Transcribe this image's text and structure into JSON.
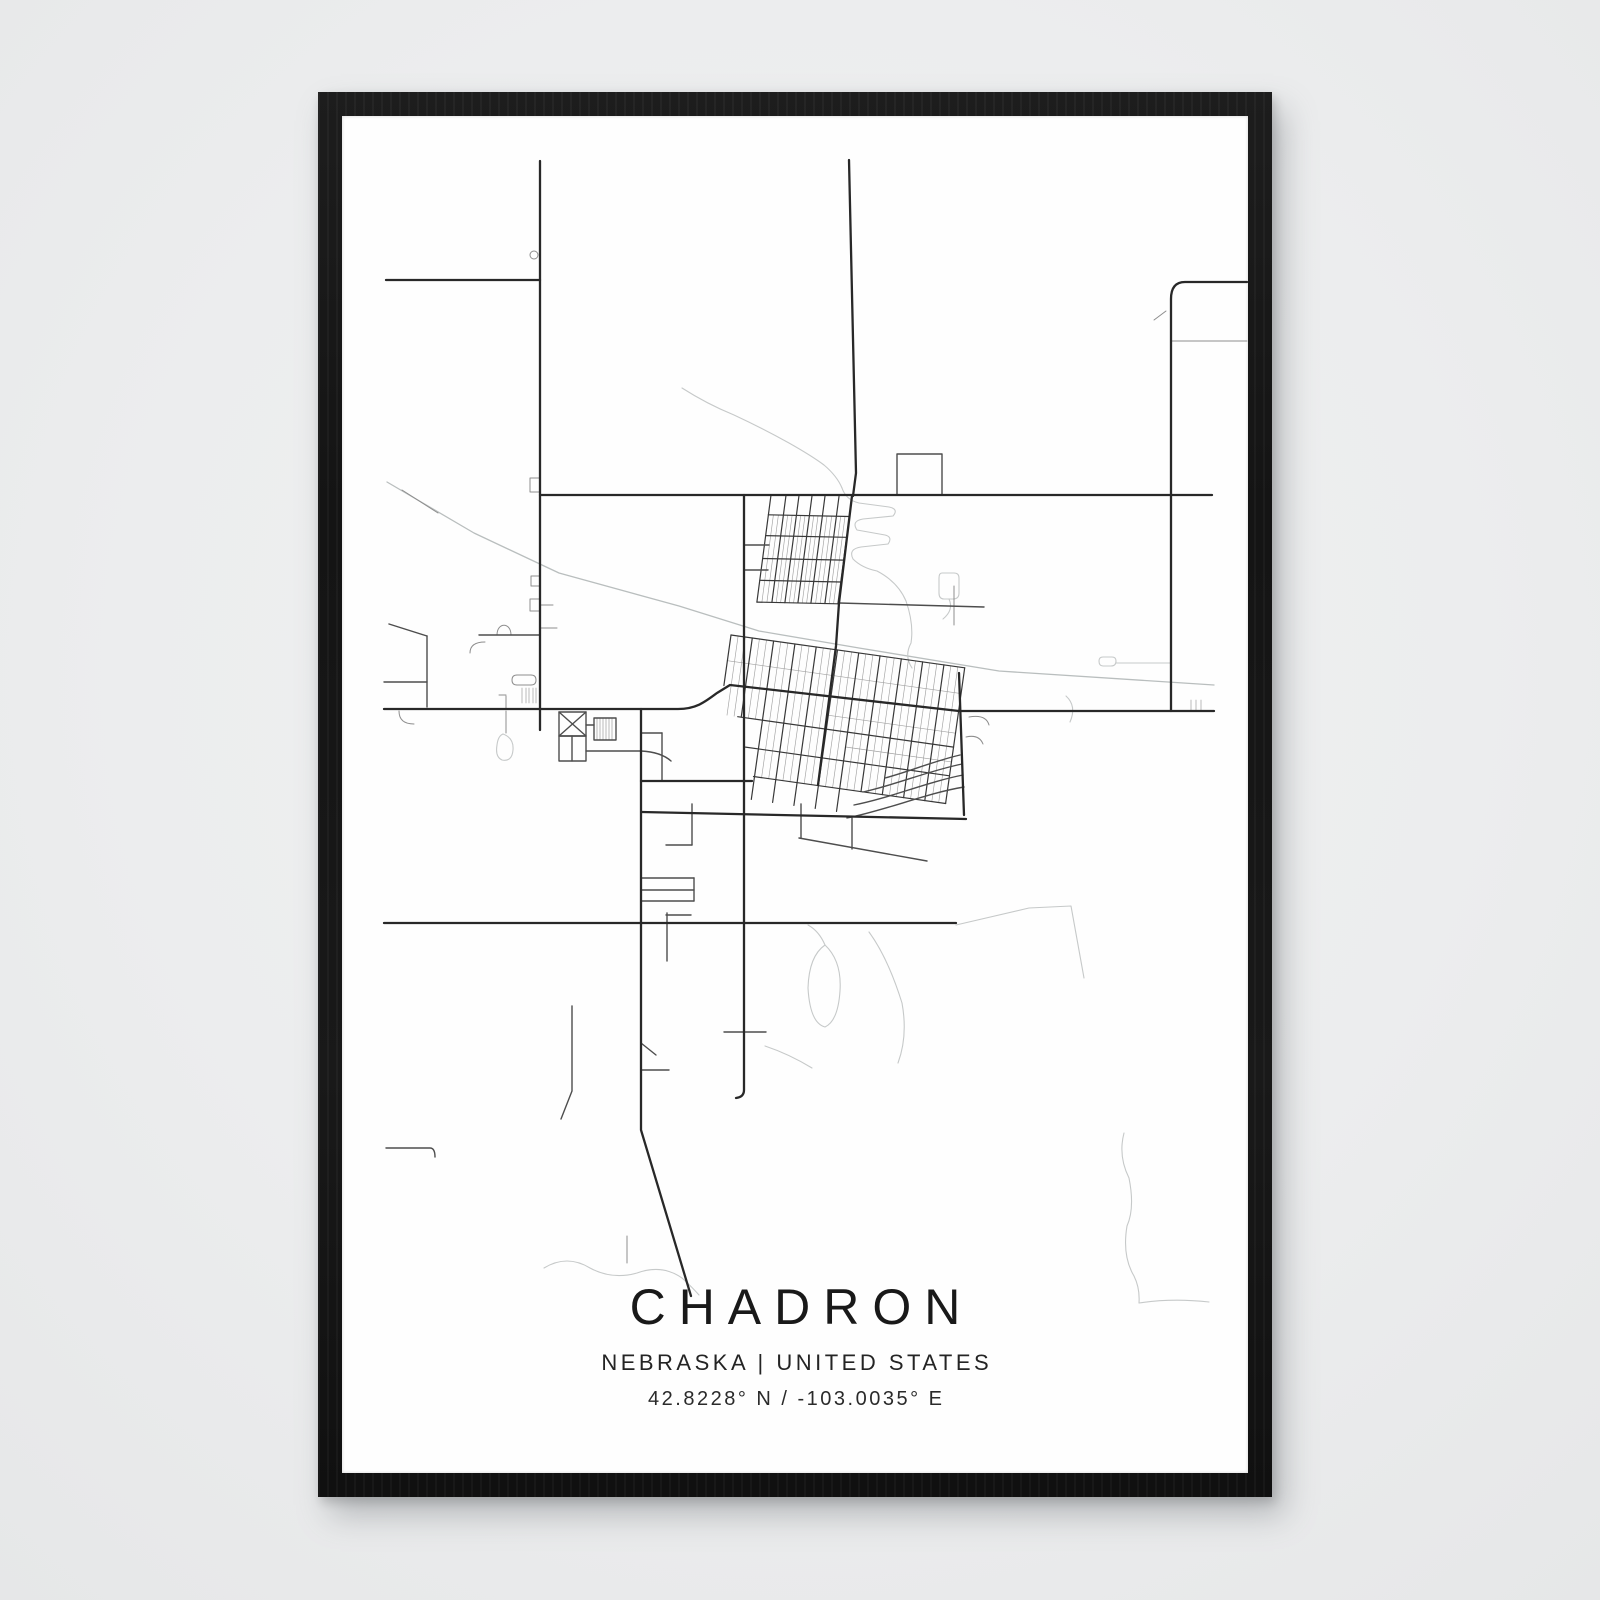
{
  "poster": {
    "title": "CHADRON",
    "subtitle": "NEBRASKA | UNITED STATES",
    "coordinates": "42.8228° N / -103.0035° E",
    "city": "Chadron",
    "region": "Nebraska",
    "country": "United States",
    "latitude": "42.8228° N",
    "longitude": "-103.0035° E"
  },
  "frame": {
    "color": "#161616",
    "scene_background": "#ecedee",
    "poster_background": "#fefefe"
  },
  "map": {
    "viewBox": "0 0 906 1357",
    "colors": {
      "major": "#282828",
      "medium": "#4d4d4d",
      "minor": "#8d8d8d",
      "thin": "#9c9c9c",
      "grid": "#383838",
      "gridThin": "#a2a2a2",
      "rail": "#b9bebe",
      "water": "#c6c9c9"
    },
    "layers": [
      {
        "name": "rail",
        "color": "rail",
        "width": 1.3,
        "paths": [
          "M45,366 L132,417 L217,457 L337,490 L417,515 L517,532 L657,555 L872,569"
        ]
      },
      {
        "name": "water",
        "color": "water",
        "width": 1.1,
        "paths": [
          "M340,272 Q365,288 392,299 Q420,312 447,327 Q470,340 482,349 Q495,360 500,372",
          "M500,372 Q504,384 517,387 L547,391 Q557,393 551,400 L521,403 Q509,405 515,414 L543,419 Q551,421 546,428 L519,431 Q506,433 511,443 Q520,452 535,455 Q556,466 564,485 Q572,508 569,527 Q562,540 570,552",
          "M483,829 Q500,845 498,875 Q496,905 483,911 Q468,907 466,872 Q467,840 483,829",
          "M483,829 Q477,815 466,809",
          "M527,816 Q546,842 560,887 Q566,920 556,947",
          "M782,1017 Q776,1040 787,1062 Q793,1092 785,1110 Q780,1140 792,1160 Q798,1172 797,1187",
          "M797,1187 Q830,1182 867,1186",
          "M202,1152 Q225,1138 248,1152 Q270,1164 295,1157 Q320,1148 340,1162 Q350,1171 357,1179",
          "M423,930 Q447,938 470,952",
          "M774,547 H829",
          "M761,541 H770 Q774,541 774,545 Q774,550 769,550 H761 Q757,550 757,545 Q757,541 761,541",
          "M600,457 H612 Q617,457 617,462 V477 Q617,483 611,483 H602 Q597,483 597,477 V462 Q597,457 600,457",
          "M607,483 Q612,494 601,503",
          "M724,580 Q735,590 728,606",
          "M161,618 Q172,622 171,634 Q170,646 160,644 Q153,641 155,629 Q156,620 161,618",
          "M614,809 L687,792 L729,790 L742,862"
        ]
      },
      {
        "name": "minor",
        "color": "minor",
        "width": 1,
        "paths": [
          "M60,374 L96,397",
          "M812,204 L824,195",
          "M829,225 H905",
          "M285,1120 V1147",
          "M188,139 a4,4 0 1 0 8,0 a4,4 0 1 0 -8,0",
          "M198,362 H188 V376 H198",
          "M198,460 H189 V470 H198",
          "M198,483 H188 V495 H198",
          "M198,489 H211",
          "M198,512 H215",
          "M164,580 V592",
          "M157,579 H164",
          "M164,595 V617",
          "M57,595 Q57,608 72,608",
          "M128,537 Q128,526 143,526",
          "M155,519 C155,506 169,506 169,519",
          "M175,559 H189 Q194,559 194,564 Q194,569 189,569 H175 Q170,569 170,564 Q170,559 175,559",
          "M612,470 V509",
          "M627,601 Q644,598 647,609",
          "M624,621 Q637,618 641,628"
        ]
      },
      {
        "name": "thin",
        "color": "thin",
        "width": 0.7,
        "paths": [
          "M180,572 V587",
          "M184,572 V587",
          "M187,572 V587",
          "M191,572 V587",
          "M194,572 V587",
          "M255,602 V624",
          "M258,602 V624",
          "M261,602 V624",
          "M264,602 V624",
          "M267,602 V624",
          "M270,602 V624",
          "M849,584 V594",
          "M854,584 V594",
          "M859,584 V594"
        ]
      },
      {
        "name": "medium",
        "color": "medium",
        "width": 1.4,
        "paths": [
          "M555,379 V338 H600 V379",
          "M244,635 H299 Q319,636 329,645",
          "M299,617 H320",
          "M320,617 V665",
          "M299,762 H352",
          "M299,774 H352",
          "M299,785 H352",
          "M352,762 V785",
          "M325,797 V845",
          "M324,799 H349",
          "M350,688 V729",
          "M324,729 H350",
          "M299,954 H327",
          "M299,927 L314,939",
          "M382,916 H424",
          "M230,890 V975 L219,1003",
          "M44,1032 H88 Q93,1032 93,1041",
          "M457,722 L585,745",
          "M459,688 V722",
          "M510,702 V733",
          "M505,702 C545,694 585,677 622,671",
          "M512,689 C548,682 585,666 621,659",
          "M521,676 C553,669 586,655 620,648",
          "M543,662 C566,656 592,645 618,639",
          "M497,487 L642,491",
          "M402,429 H427",
          "M402,454 H426",
          "M217,596 H244 V620 H217 Z",
          "M217,596 L244,620",
          "M244,596 L217,620",
          "M217,620 H244 V645 H217 Z",
          "M230,620 V645",
          "M252,602 H274 V624 H252 Z",
          "M244,609 H252",
          "M137,519 H198",
          "M85,520 V591",
          "M42,566 H85",
          "M47,508 L85,520"
        ]
      },
      {
        "name": "major",
        "color": "major",
        "width": 2.3,
        "paths": [
          "M198,45 V614",
          "M44,164 H198",
          "M198,379 H870",
          "M507,44 L514,357 L511,380",
          "M905,166 H843 Q829,166 829,183 V595",
          "M42,593 H336 C354,593 363,586 375,577 L388,569 L617,595 H872",
          "M299,593 V1014 L349,1180",
          "M402,379 V974 Q402,981 394,982",
          "M42,807 H614",
          "M300,696 L624,703",
          "M510,380 L497,487 L494,530 L476,669",
          "M617,557 L622,699",
          "M299,665 H410"
        ]
      }
    ],
    "grids": [
      {
        "name": "north-grid",
        "origin": [
          429,
          379
        ],
        "uAngle": 1.2,
        "vAngle": 97.5,
        "width": 81,
        "cols": [
          0,
          15,
          28,
          41,
          54,
          68,
          81
        ],
        "colSpan": [
          0,
          108
        ],
        "rows": [
          20,
          41,
          64,
          86,
          108
        ],
        "rowStarts": [
          0,
          0,
          0,
          0,
          0
        ],
        "thin": {
          "perGap": 2,
          "span": [
            20,
            108
          ]
        }
      },
      {
        "name": "main-grid",
        "origin": [
          389,
          519
        ],
        "uAngle": 8,
        "vAngle": 98,
        "width": 236,
        "cols": [
          0,
          21.5,
          43,
          64.5,
          86,
          107.5,
          129,
          150.5,
          172,
          193.5,
          215,
          236
        ],
        "colSpan": [
          0,
          137
        ],
        "colSpansByIndex": {
          "0": [
            0,
            51
          ],
          "1": [
            0,
            80
          ]
        },
        "rows": [
          0,
          80,
          109,
          137
        ],
        "rowStarts": [
          0,
          18,
          30,
          42
        ],
        "thinRows": [
          [
            26,
            0,
            236
          ],
          [
            66,
            107,
            236
          ],
          [
            95,
            129,
            236
          ]
        ],
        "thin": {
          "perGap": 2,
          "span": [
            0,
            137
          ],
          "shortSpan": [
            0,
            80
          ],
          "shortBelowU": 43
        },
        "stubs": {
          "cols": [
            43,
            64.5,
            86,
            107.5,
            129
          ],
          "len": 23
        }
      }
    ]
  }
}
